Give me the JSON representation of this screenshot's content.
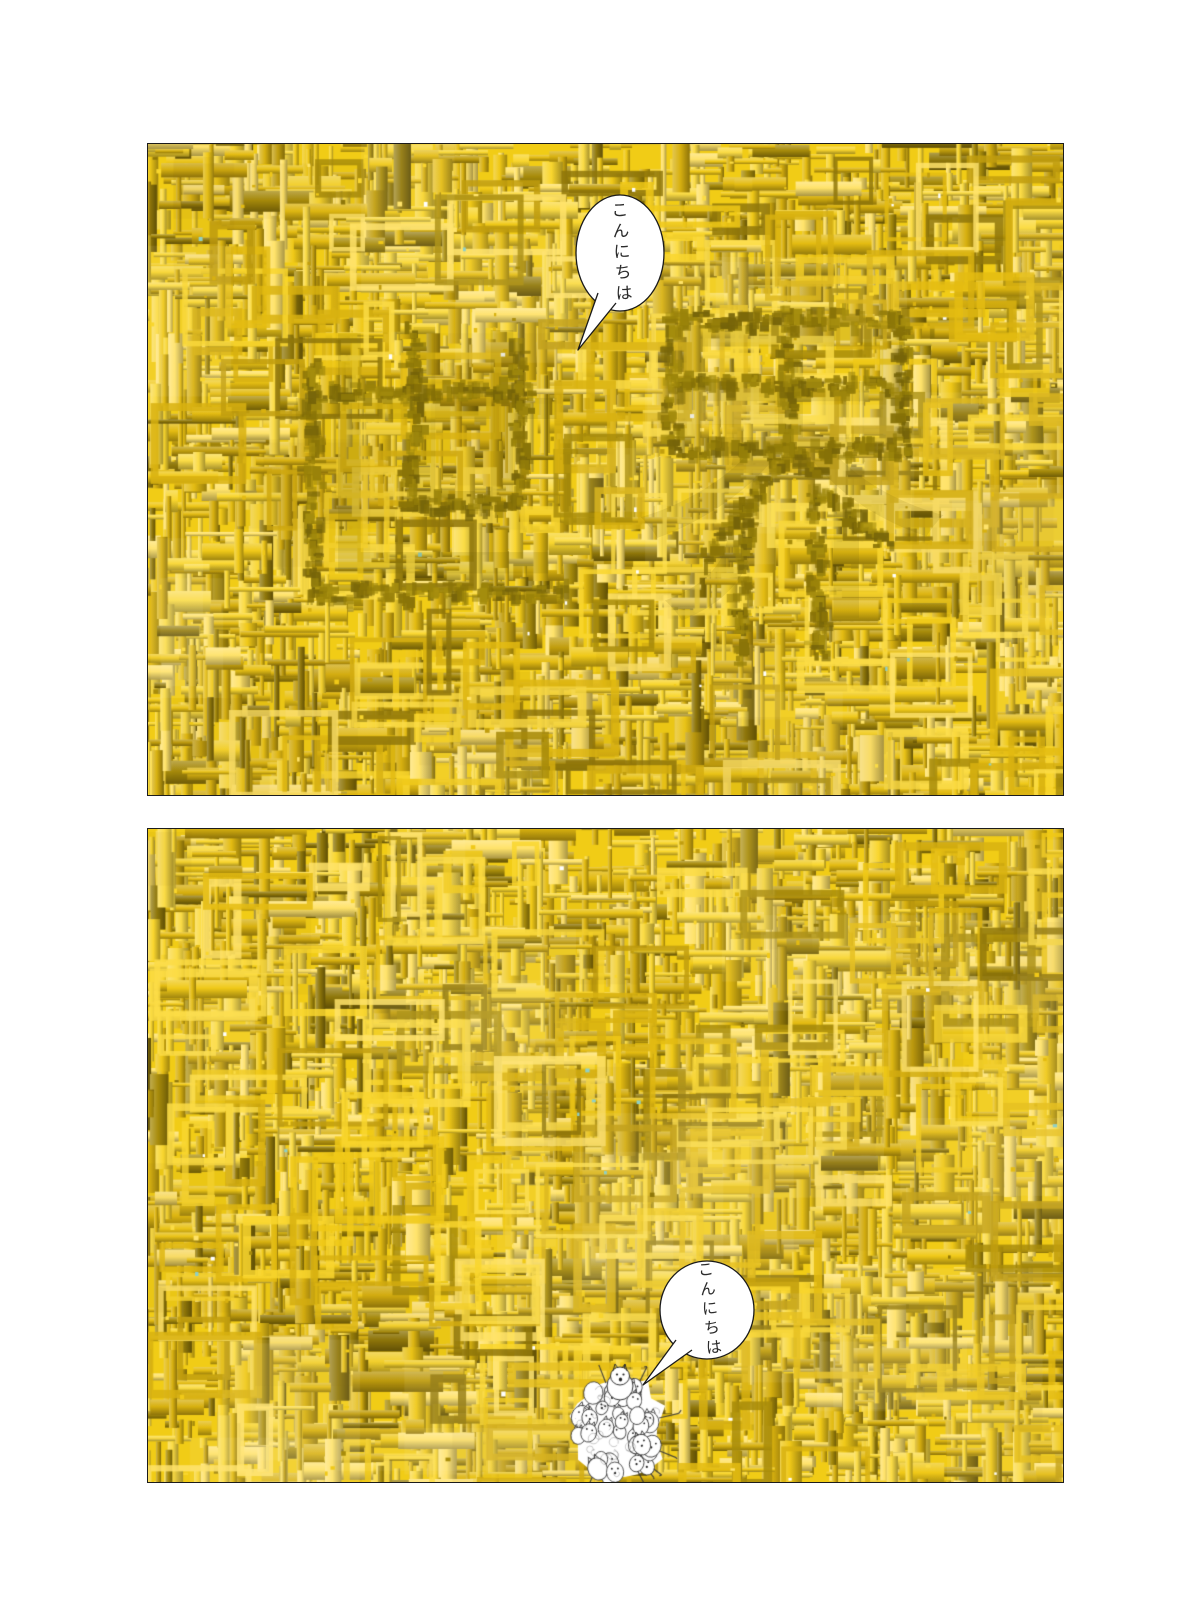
{
  "page": {
    "background_color": "#ffffff",
    "kind": "two-panel comic page"
  },
  "panels": [
    {
      "name": "top-panel",
      "bubble": {
        "text": "こんにちは"
      },
      "embedded_text": "世界",
      "embedded_chars": [
        "世",
        "界"
      ]
    },
    {
      "name": "bottom-panel",
      "bubble": {
        "text": "こんにちは"
      },
      "creature_icon": "crowd-of-tiny-white-figures-icon"
    }
  ],
  "colors": {
    "mosaic_base": "#f1cc16",
    "mosaic_light": [
      "#ffe36a",
      "#fbdc45",
      "#f9d62e"
    ],
    "mosaic_mid": [
      "#f0c918",
      "#e4bc12",
      "#d8b110"
    ],
    "mosaic_dark": [
      "#c19e0e",
      "#a88c0b",
      "#8f770a"
    ],
    "kanji_dark": [
      "#8a7408",
      "#9a830a",
      "#77650a",
      "#a58d0e"
    ],
    "accent_speck": "#8fd0c6",
    "panel_border": "#1c1c1c",
    "bubble_fill": "#ffffff",
    "bubble_stroke": "#1a1a1a",
    "bubble_text_color": "#2b2b2b",
    "figure_stroke": "#3a3a3a"
  }
}
